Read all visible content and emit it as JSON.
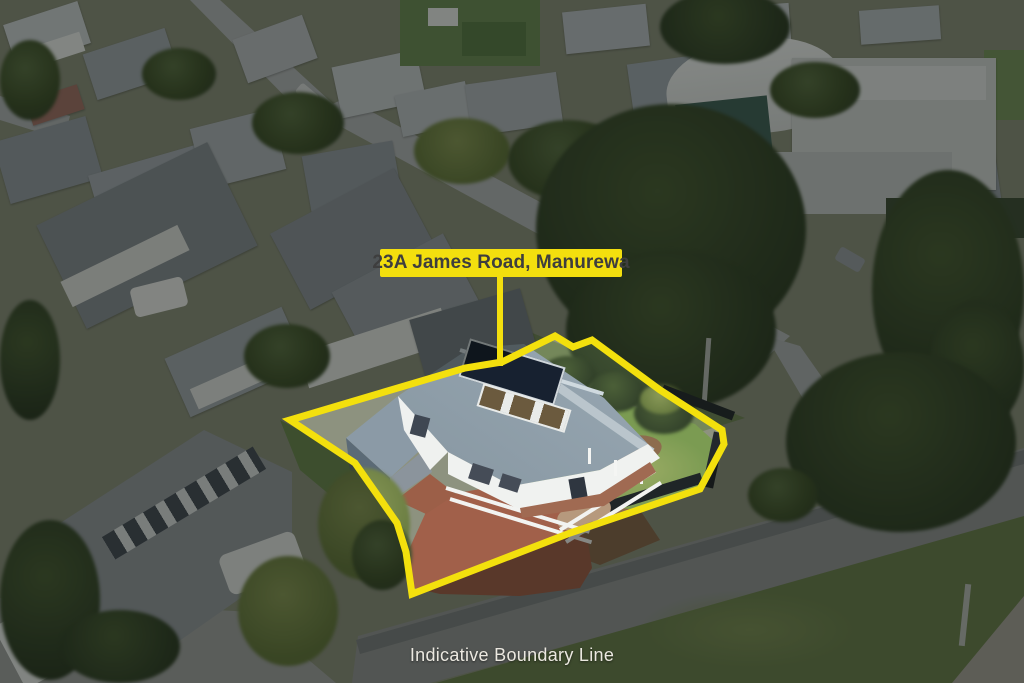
{
  "scene": {
    "kind": "aerial-property-photo",
    "address_label": {
      "text": "23A James Road, Manurewa",
      "bg_color": "#F3DF0E",
      "text_color": "#3E3E3E"
    },
    "caption": {
      "text": "Indicative Boundary Line",
      "color": "#EBE8E0"
    },
    "boundary": {
      "color": "#F3E00D",
      "stroke_width": 7,
      "points": "290,420 465,368 502,362 555,336 573,347 592,340 660,390 722,430 724,444 700,489 570,533 412,594 406,552 397,523 355,463",
      "dim_color": "rgba(5,8,5,0.46)"
    }
  }
}
